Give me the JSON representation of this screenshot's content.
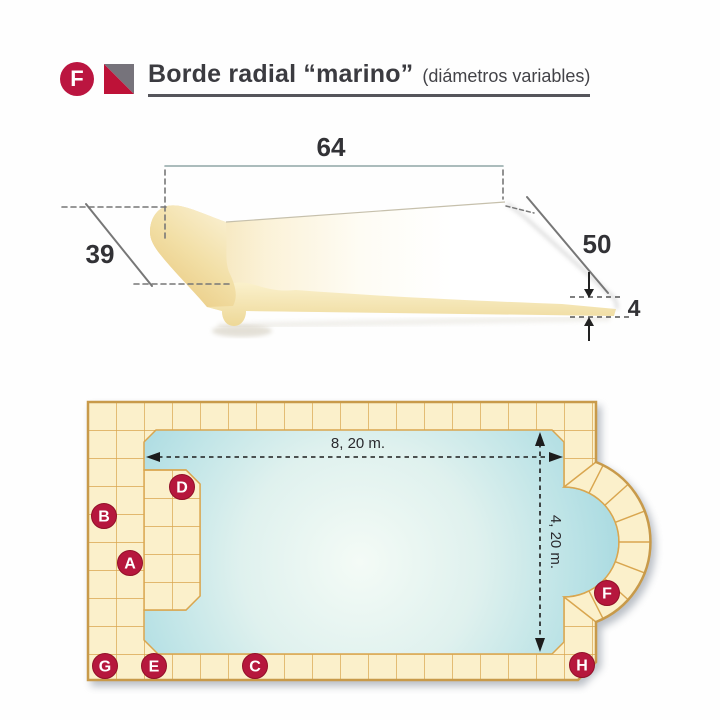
{
  "header": {
    "badge_letter": "F",
    "title": "Borde radial “marino”",
    "subtitle": "(diámetros variables)"
  },
  "piece": {
    "dim_top": "64",
    "dim_left": "39",
    "dim_right": "50",
    "dim_thickness": "4"
  },
  "pool": {
    "width_label": "8, 20 m.",
    "height_label": "4, 20 m.",
    "markers": [
      {
        "letter": "A"
      },
      {
        "letter": "B"
      },
      {
        "letter": "C"
      },
      {
        "letter": "D"
      },
      {
        "letter": "E"
      },
      {
        "letter": "F"
      },
      {
        "letter": "G"
      },
      {
        "letter": "H"
      }
    ]
  },
  "colors": {
    "accent_crimson": "#BB1540",
    "logo_gray": "#76737b",
    "tile_fill": "#FBF0CB",
    "tile_grout": "#D9A64F",
    "outer_outline": "#C89A4A",
    "water_edge": "#A9DAE1",
    "water_center": "#F4FBF6",
    "piece_cream": "#E9CB86"
  }
}
